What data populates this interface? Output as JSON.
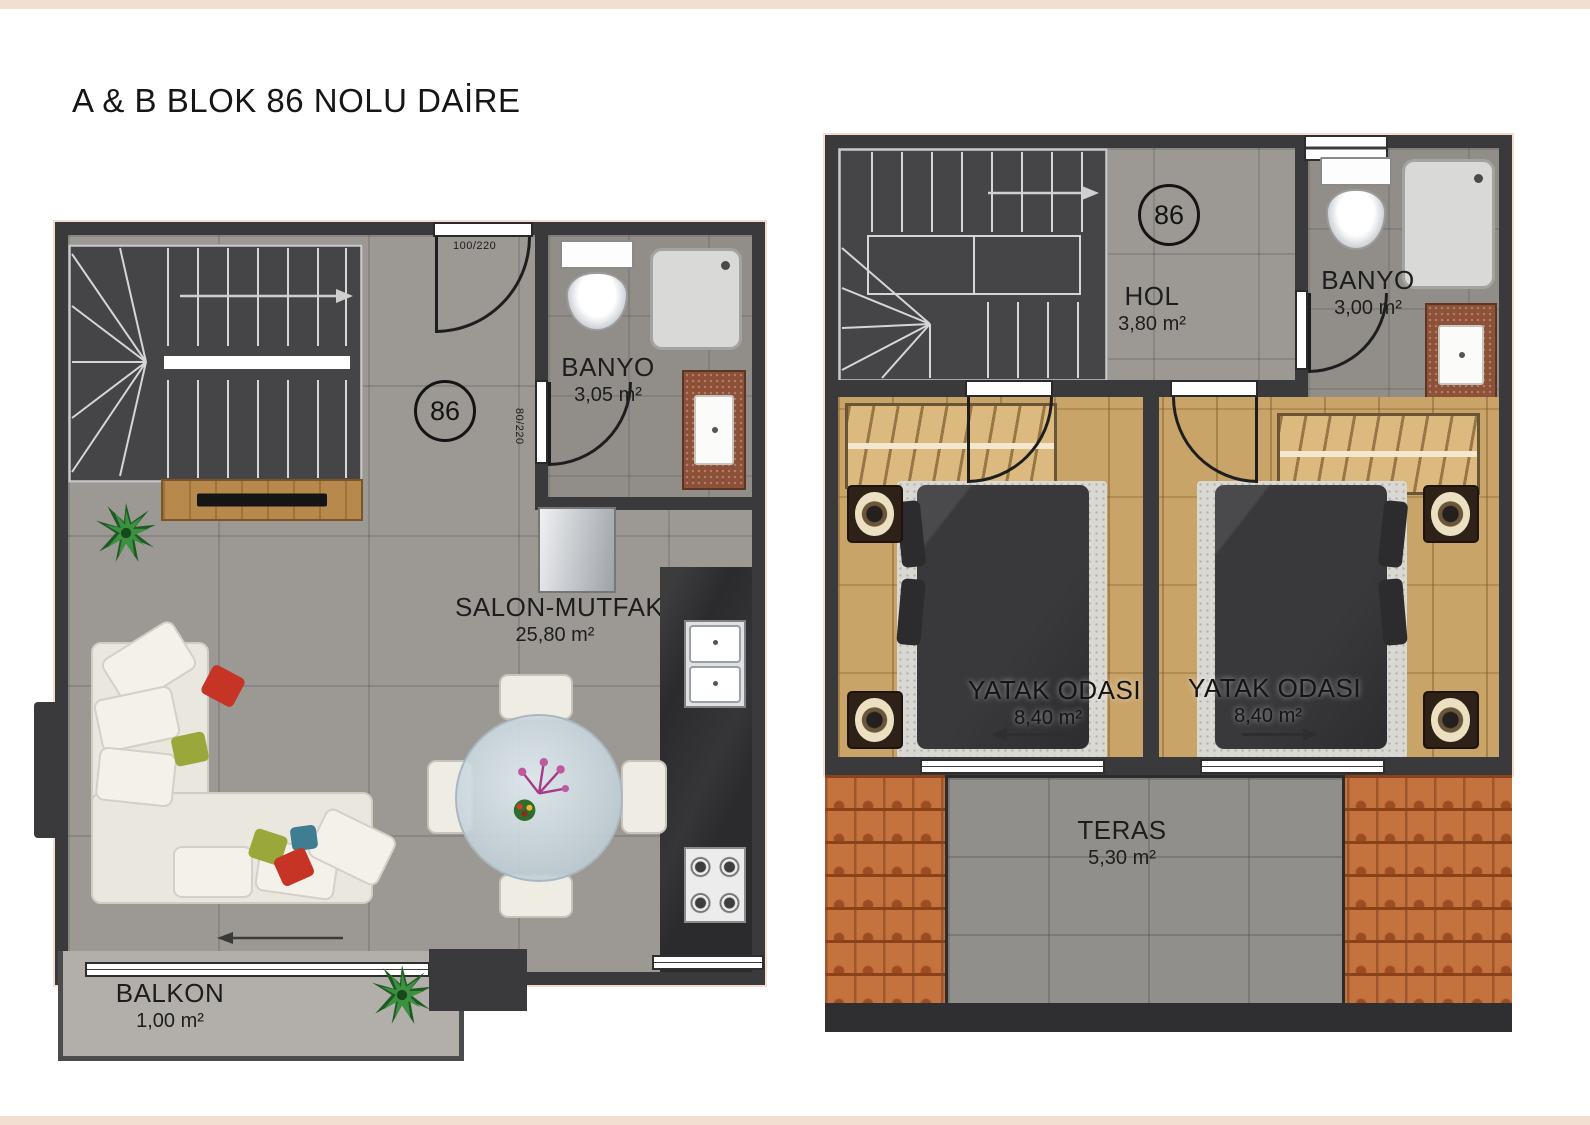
{
  "page": {
    "title": "A & B BLOK 86 NOLU DAİRE"
  },
  "floor1": {
    "unit_badge": "86",
    "doors": {
      "entry": "100/220",
      "bath": "80/220"
    },
    "rooms": {
      "banyo": {
        "name": "BANYO",
        "area": "3,05 m²"
      },
      "salon": {
        "name": "SALON-MUTFAK",
        "area": "25,80 m²"
      },
      "balkon": {
        "name": "BALKON",
        "area": "1,00 m²"
      }
    }
  },
  "floor2": {
    "unit_badge": "86",
    "rooms": {
      "hol": {
        "name": "HOL",
        "area": "3,80 m²"
      },
      "banyo": {
        "name": "BANYO",
        "area": "3,00 m²"
      },
      "yatak1": {
        "name": "YATAK ODASI",
        "area": "8,40 m²"
      },
      "yatak2": {
        "name": "YATAK ODASI",
        "area": "8,40 m²"
      },
      "teras": {
        "name": "TERAS",
        "area": "5,30 m²"
      }
    }
  },
  "colors": {
    "wall": "#3a3a3c",
    "floor_tile": "#9c9995",
    "bath_floor": "#918e8a",
    "stairs": "#454547",
    "wood_floor": "#c9a469",
    "wardrobe": "#dcb97e",
    "kitchen_counter": "#2b2b2d",
    "sofa": "#eae7de",
    "roof_tiles": "#c4723e",
    "terrace": "#918f8b",
    "balcony": "#b2afaa",
    "accent_band": "#f3ded2",
    "marble_counter": "#8d5138"
  }
}
